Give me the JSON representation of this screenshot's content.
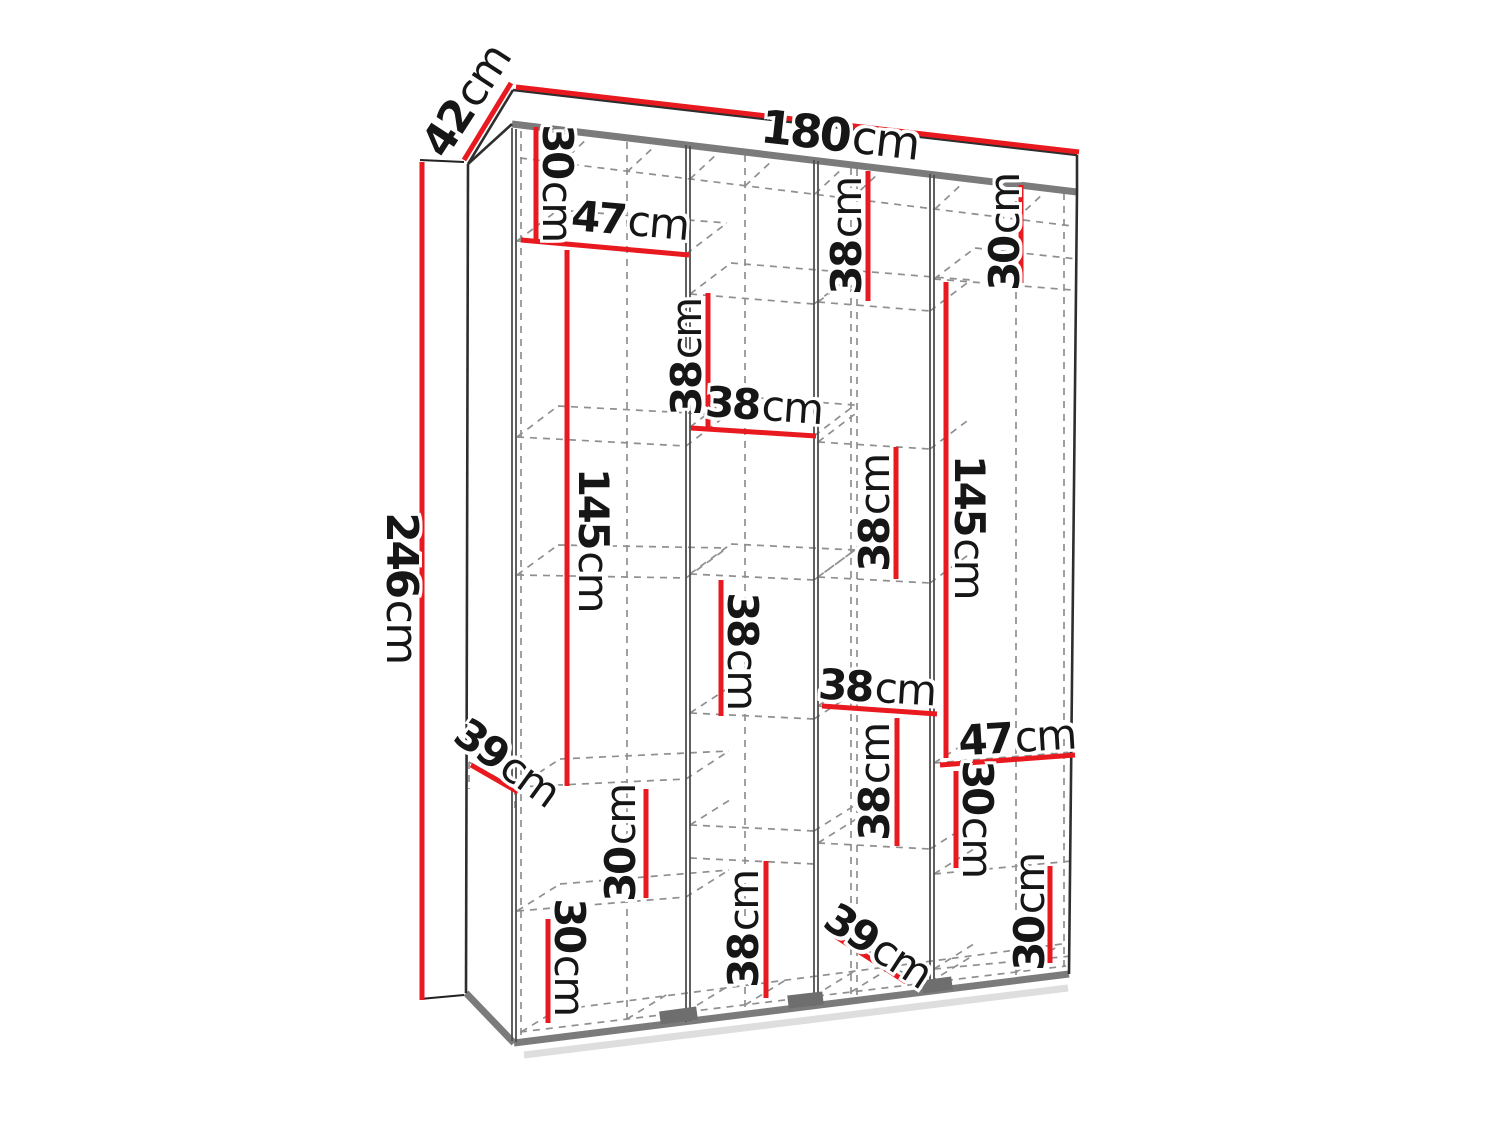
{
  "meta": {
    "description": "Technical dimension diagram of a four-section wardrobe drawn in perspective with dashed interior shelves and red dimension lines",
    "unit": "cm"
  },
  "overall_dimensions": {
    "width_cm": 180,
    "depth_cm": 42,
    "height_cm": 246
  },
  "interior_dimensions_cm": [
    30,
    47,
    145,
    39,
    30,
    30,
    38,
    38,
    38,
    38,
    38,
    38,
    38,
    39,
    30,
    145,
    47,
    30,
    30
  ],
  "colors": {
    "red": "#e8191f",
    "outline": "#2e2e2e",
    "inner_wall": "#4f4f4f",
    "panel_gray": "#7b7b7b",
    "dashed": "#8f8f8f",
    "text": "#161616",
    "background": "#ffffff"
  },
  "labels": [
    {
      "id": "depth-42",
      "value": "42",
      "unit": "cm",
      "x": 467,
      "y": 101,
      "rot": -57,
      "size": 44
    },
    {
      "id": "width-180",
      "value": "180",
      "unit": "cm",
      "x": 840,
      "y": 135,
      "rot": 6.5,
      "size": 46
    },
    {
      "id": "height-246",
      "value": "246",
      "unit": "cm",
      "x": 401,
      "y": 588,
      "rot": 90,
      "size": 44
    },
    {
      "id": "c1-30-top",
      "value": "30",
      "unit": "cm",
      "x": 557,
      "y": 183,
      "rot": 90,
      "size": 42
    },
    {
      "id": "c1-47-shelf",
      "value": "47",
      "unit": "cm",
      "x": 630,
      "y": 221,
      "rot": 5,
      "size": 42
    },
    {
      "id": "c1-145",
      "value": "145",
      "unit": "cm",
      "x": 593,
      "y": 540,
      "rot": 90,
      "size": 42
    },
    {
      "id": "c1-39-step",
      "value": "39",
      "unit": "cm",
      "x": 507,
      "y": 763,
      "rot": 36,
      "size": 42
    },
    {
      "id": "c1-30-mid",
      "value": "30",
      "unit": "cm",
      "x": 621,
      "y": 843,
      "rot": -90,
      "size": 42
    },
    {
      "id": "c1-30-bottom",
      "value": "30",
      "unit": "cm",
      "x": 569,
      "y": 957,
      "rot": 90,
      "size": 42
    },
    {
      "id": "c2-38-top",
      "value": "38",
      "unit": "cm",
      "x": 687,
      "y": 357,
      "rot": -90,
      "size": 42
    },
    {
      "id": "c2-38-shelf",
      "value": "38",
      "unit": "cm",
      "x": 764,
      "y": 406,
      "rot": 4,
      "size": 42
    },
    {
      "id": "c2-38-mid",
      "value": "38",
      "unit": "cm",
      "x": 742,
      "y": 651,
      "rot": 90,
      "size": 42
    },
    {
      "id": "c2-38-bottom",
      "value": "38",
      "unit": "cm",
      "x": 744,
      "y": 929,
      "rot": -90,
      "size": 42
    },
    {
      "id": "c3-38-top",
      "value": "38",
      "unit": "cm",
      "x": 847,
      "y": 236,
      "rot": -90,
      "size": 42
    },
    {
      "id": "c3-38-mid",
      "value": "38",
      "unit": "cm",
      "x": 875,
      "y": 513,
      "rot": -90,
      "size": 42
    },
    {
      "id": "c3-38-shelf",
      "value": "38",
      "unit": "cm",
      "x": 877,
      "y": 688,
      "rot": 3.5,
      "size": 42
    },
    {
      "id": "c3-38-low",
      "value": "38",
      "unit": "cm",
      "x": 875,
      "y": 782,
      "rot": -90,
      "size": 42
    },
    {
      "id": "c3-39-step",
      "value": "39",
      "unit": "cm",
      "x": 878,
      "y": 946,
      "rot": 33,
      "size": 42
    },
    {
      "id": "c4-30-top",
      "value": "30",
      "unit": "cm",
      "x": 1005,
      "y": 232,
      "rot": -90,
      "size": 42
    },
    {
      "id": "c4-145",
      "value": "145",
      "unit": "cm",
      "x": 969,
      "y": 527,
      "rot": 90,
      "size": 42
    },
    {
      "id": "c4-47-shelf",
      "value": "47",
      "unit": "cm",
      "x": 1017,
      "y": 738,
      "rot": -3.5,
      "size": 42
    },
    {
      "id": "c4-30-mid",
      "value": "30",
      "unit": "cm",
      "x": 977,
      "y": 819,
      "rot": 90,
      "size": 42
    },
    {
      "id": "c4-30-bottom",
      "value": "30",
      "unit": "cm",
      "x": 1030,
      "y": 912,
      "rot": -90,
      "size": 42
    }
  ],
  "polygons": [
    {
      "name": "wardrobe-top-face",
      "points": "513,90 1077,155 1077,192 468,165",
      "fill": "#ffffff"
    }
  ],
  "line_groups": [
    {
      "name": "floor-shadow-line",
      "color": "#dedede",
      "width": 7,
      "lines": [
        [
          524,
          1055,
          1068,
          988
        ]
      ]
    },
    {
      "name": "dashed-construction-line",
      "color": "#8f8f8f",
      "width": 1.7,
      "dash": "7 6",
      "lines": [
        [
          521,
          131,
          521,
          1041
        ],
        [
          627,
          142,
          627,
          1029
        ],
        [
          745,
          155,
          745,
          1014
        ],
        [
          851,
          168,
          851,
          1001
        ],
        [
          857,
          169,
          857,
          1000
        ],
        [
          1016,
          188,
          1016,
          981
        ],
        [
          1064,
          193,
          1064,
          975
        ],
        [
          520,
          158,
          1072,
          226
        ],
        [
          560,
          164,
          588,
          138
        ],
        [
          627,
          172,
          655,
          146
        ],
        [
          690,
          179,
          718,
          153
        ],
        [
          745,
          186,
          773,
          160
        ],
        [
          815,
          194,
          843,
          168
        ],
        [
          851,
          199,
          879,
          173
        ],
        [
          935,
          209,
          963,
          183
        ],
        [
          1016,
          219,
          1044,
          193
        ],
        [
          520,
          1032,
          1066,
          966
        ],
        [
          565,
          1009,
          1062,
          944
        ],
        [
          521,
          1032,
          565,
          1005
        ],
        [
          627,
          1019,
          671,
          992
        ],
        [
          686,
          1012,
          730,
          985
        ],
        [
          745,
          1005,
          789,
          978
        ],
        [
          814,
          996,
          858,
          969
        ],
        [
          851,
          992,
          895,
          965
        ],
        [
          930,
          982,
          974,
          955
        ],
        [
          1016,
          972,
          1060,
          945
        ],
        [
          517,
          241,
          688,
          255
        ],
        [
          517,
          241,
          558,
          210
        ],
        [
          686,
          254,
          727,
          223
        ],
        [
          558,
          210,
          727,
          223
        ],
        [
          517,
          437,
          686,
          446
        ],
        [
          517,
          437,
          558,
          406
        ],
        [
          686,
          446,
          727,
          415
        ],
        [
          558,
          406,
          727,
          415
        ],
        [
          517,
          575,
          686,
          578
        ],
        [
          517,
          575,
          558,
          545
        ],
        [
          686,
          578,
          727,
          548
        ],
        [
          558,
          545,
          727,
          548
        ],
        [
          517,
          787,
          686,
          779
        ],
        [
          517,
          787,
          560,
          759
        ],
        [
          686,
          779,
          729,
          751
        ],
        [
          560,
          759,
          729,
          751
        ],
        [
          517,
          911,
          686,
          897
        ],
        [
          517,
          911,
          560,
          884
        ],
        [
          686,
          897,
          729,
          870
        ],
        [
          560,
          884,
          729,
          870
        ],
        [
          690,
          294,
          814,
          304
        ],
        [
          690,
          294,
          731,
          263
        ],
        [
          814,
          304,
          855,
          273
        ],
        [
          731,
          263,
          855,
          273
        ],
        [
          690,
          427,
          814,
          436
        ],
        [
          690,
          427,
          731,
          396
        ],
        [
          814,
          436,
          855,
          405
        ],
        [
          731,
          396,
          855,
          405
        ],
        [
          690,
          574,
          814,
          580
        ],
        [
          690,
          574,
          731,
          544
        ],
        [
          814,
          580,
          855,
          550
        ],
        [
          731,
          544,
          855,
          550
        ],
        [
          690,
          713,
          814,
          719
        ],
        [
          690,
          713,
          733,
          685
        ],
        [
          814,
          719,
          857,
          691
        ],
        [
          690,
          825,
          814,
          831
        ],
        [
          690,
          825,
          733,
          798
        ],
        [
          814,
          831,
          857,
          804
        ],
        [
          690,
          858,
          814,
          864
        ],
        [
          818,
          302,
          930,
          311
        ],
        [
          818,
          302,
          859,
          271
        ],
        [
          930,
          311,
          971,
          280
        ],
        [
          859,
          271,
          971,
          280
        ],
        [
          818,
          442,
          930,
          449
        ],
        [
          818,
          442,
          859,
          411
        ],
        [
          930,
          449,
          971,
          418
        ],
        [
          818,
          577,
          930,
          583
        ],
        [
          818,
          577,
          859,
          547
        ],
        [
          930,
          583,
          971,
          553
        ],
        [
          818,
          706,
          936,
          713
        ],
        [
          818,
          706,
          860,
          678
        ],
        [
          818,
          843,
          930,
          849
        ],
        [
          818,
          843,
          861,
          816
        ],
        [
          930,
          849,
          973,
          822
        ],
        [
          834,
          929,
          905,
          974
        ],
        [
          934,
          279,
          1072,
          290
        ],
        [
          934,
          279,
          975,
          248
        ],
        [
          975,
          248,
          1077,
          259
        ],
        [
          934,
          763,
          1072,
          752
        ],
        [
          934,
          763,
          977,
          736
        ],
        [
          934,
          874,
          1072,
          861
        ],
        [
          934,
          874,
          977,
          847
        ],
        [
          934,
          969,
          1072,
          956
        ],
        [
          934,
          969,
          977,
          942
        ],
        [
          469,
          762,
          515,
          788
        ],
        [
          469,
          762,
          469,
          789
        ],
        [
          515,
          788,
          515,
          812
        ]
      ]
    },
    {
      "name": "panel-edge-thick",
      "color": "#7b7b7b",
      "width": 7,
      "lines": [
        [
          512,
          124,
          1077,
          192
        ],
        [
          466,
          993,
          514,
          1043
        ],
        [
          514,
          1043,
          1069,
          974
        ]
      ]
    },
    {
      "name": "inner-wall-line",
      "color": "#4f4f4f",
      "width": 1.8,
      "lines": [
        [
          512,
          128,
          512,
          1041
        ],
        [
          516,
          129,
          516,
          1042
        ],
        [
          686,
          145,
          686,
          1022
        ],
        [
          690,
          146,
          690,
          1021
        ],
        [
          814,
          160,
          814,
          1006
        ],
        [
          818,
          161,
          818,
          1005
        ],
        [
          930,
          174,
          930,
          991
        ],
        [
          934,
          175,
          934,
          990
        ]
      ]
    },
    {
      "name": "outline-edge",
      "color": "#2e2e2e",
      "width": 2.6,
      "lines": [
        [
          513,
          90,
          1077,
          155
        ],
        [
          513,
          90,
          468,
          164
        ],
        [
          1077,
          155,
          1077,
          192
        ],
        [
          468,
          164,
          512,
          124
        ],
        [
          468,
          164,
          466,
          993
        ],
        [
          1077,
          192,
          1069,
          974
        ]
      ]
    },
    {
      "name": "foot",
      "color": "#6e6e6e",
      "width": 13,
      "lines": [
        [
          660,
          1018,
          697,
          1013
        ],
        [
          788,
          1002,
          823,
          998
        ],
        [
          922,
          987,
          952,
          983
        ]
      ]
    },
    {
      "name": "dimension-tick",
      "color": "#222222",
      "width": 2,
      "lines": [
        [
          420,
          160,
          464,
          162
        ],
        [
          420,
          999,
          464,
          995
        ]
      ]
    },
    {
      "name": "dimension-line",
      "color": "#e8191f",
      "width": 5,
      "lines": [
        [
          511,
          83,
          464,
          160
        ],
        [
          516,
          87,
          1079,
          152
        ],
        [
          422,
          162,
          422,
          1000
        ],
        [
          536,
          127,
          536,
          239
        ],
        [
          521,
          240,
          689,
          255
        ],
        [
          567,
          250,
          567,
          786
        ],
        [
          471,
          765,
          518,
          792
        ],
        [
          646,
          789,
          646,
          898
        ],
        [
          548,
          919,
          548,
          1023
        ],
        [
          708,
          293,
          708,
          429
        ],
        [
          691,
          428,
          816,
          436
        ],
        [
          721,
          580,
          721,
          716
        ],
        [
          822,
          706,
          937,
          714
        ],
        [
          868,
          171,
          868,
          301
        ],
        [
          1021,
          185,
          1021,
          283
        ],
        [
          946,
          282,
          946,
          758
        ],
        [
          940,
          765,
          1075,
          755
        ],
        [
          956,
          771,
          956,
          868
        ],
        [
          1050,
          866,
          1050,
          963
        ],
        [
          897,
          718,
          897,
          846
        ],
        [
          896,
          447,
          896,
          579
        ],
        [
          766,
          861,
          766,
          998
        ],
        [
          835,
          936,
          906,
          982
        ]
      ]
    }
  ]
}
